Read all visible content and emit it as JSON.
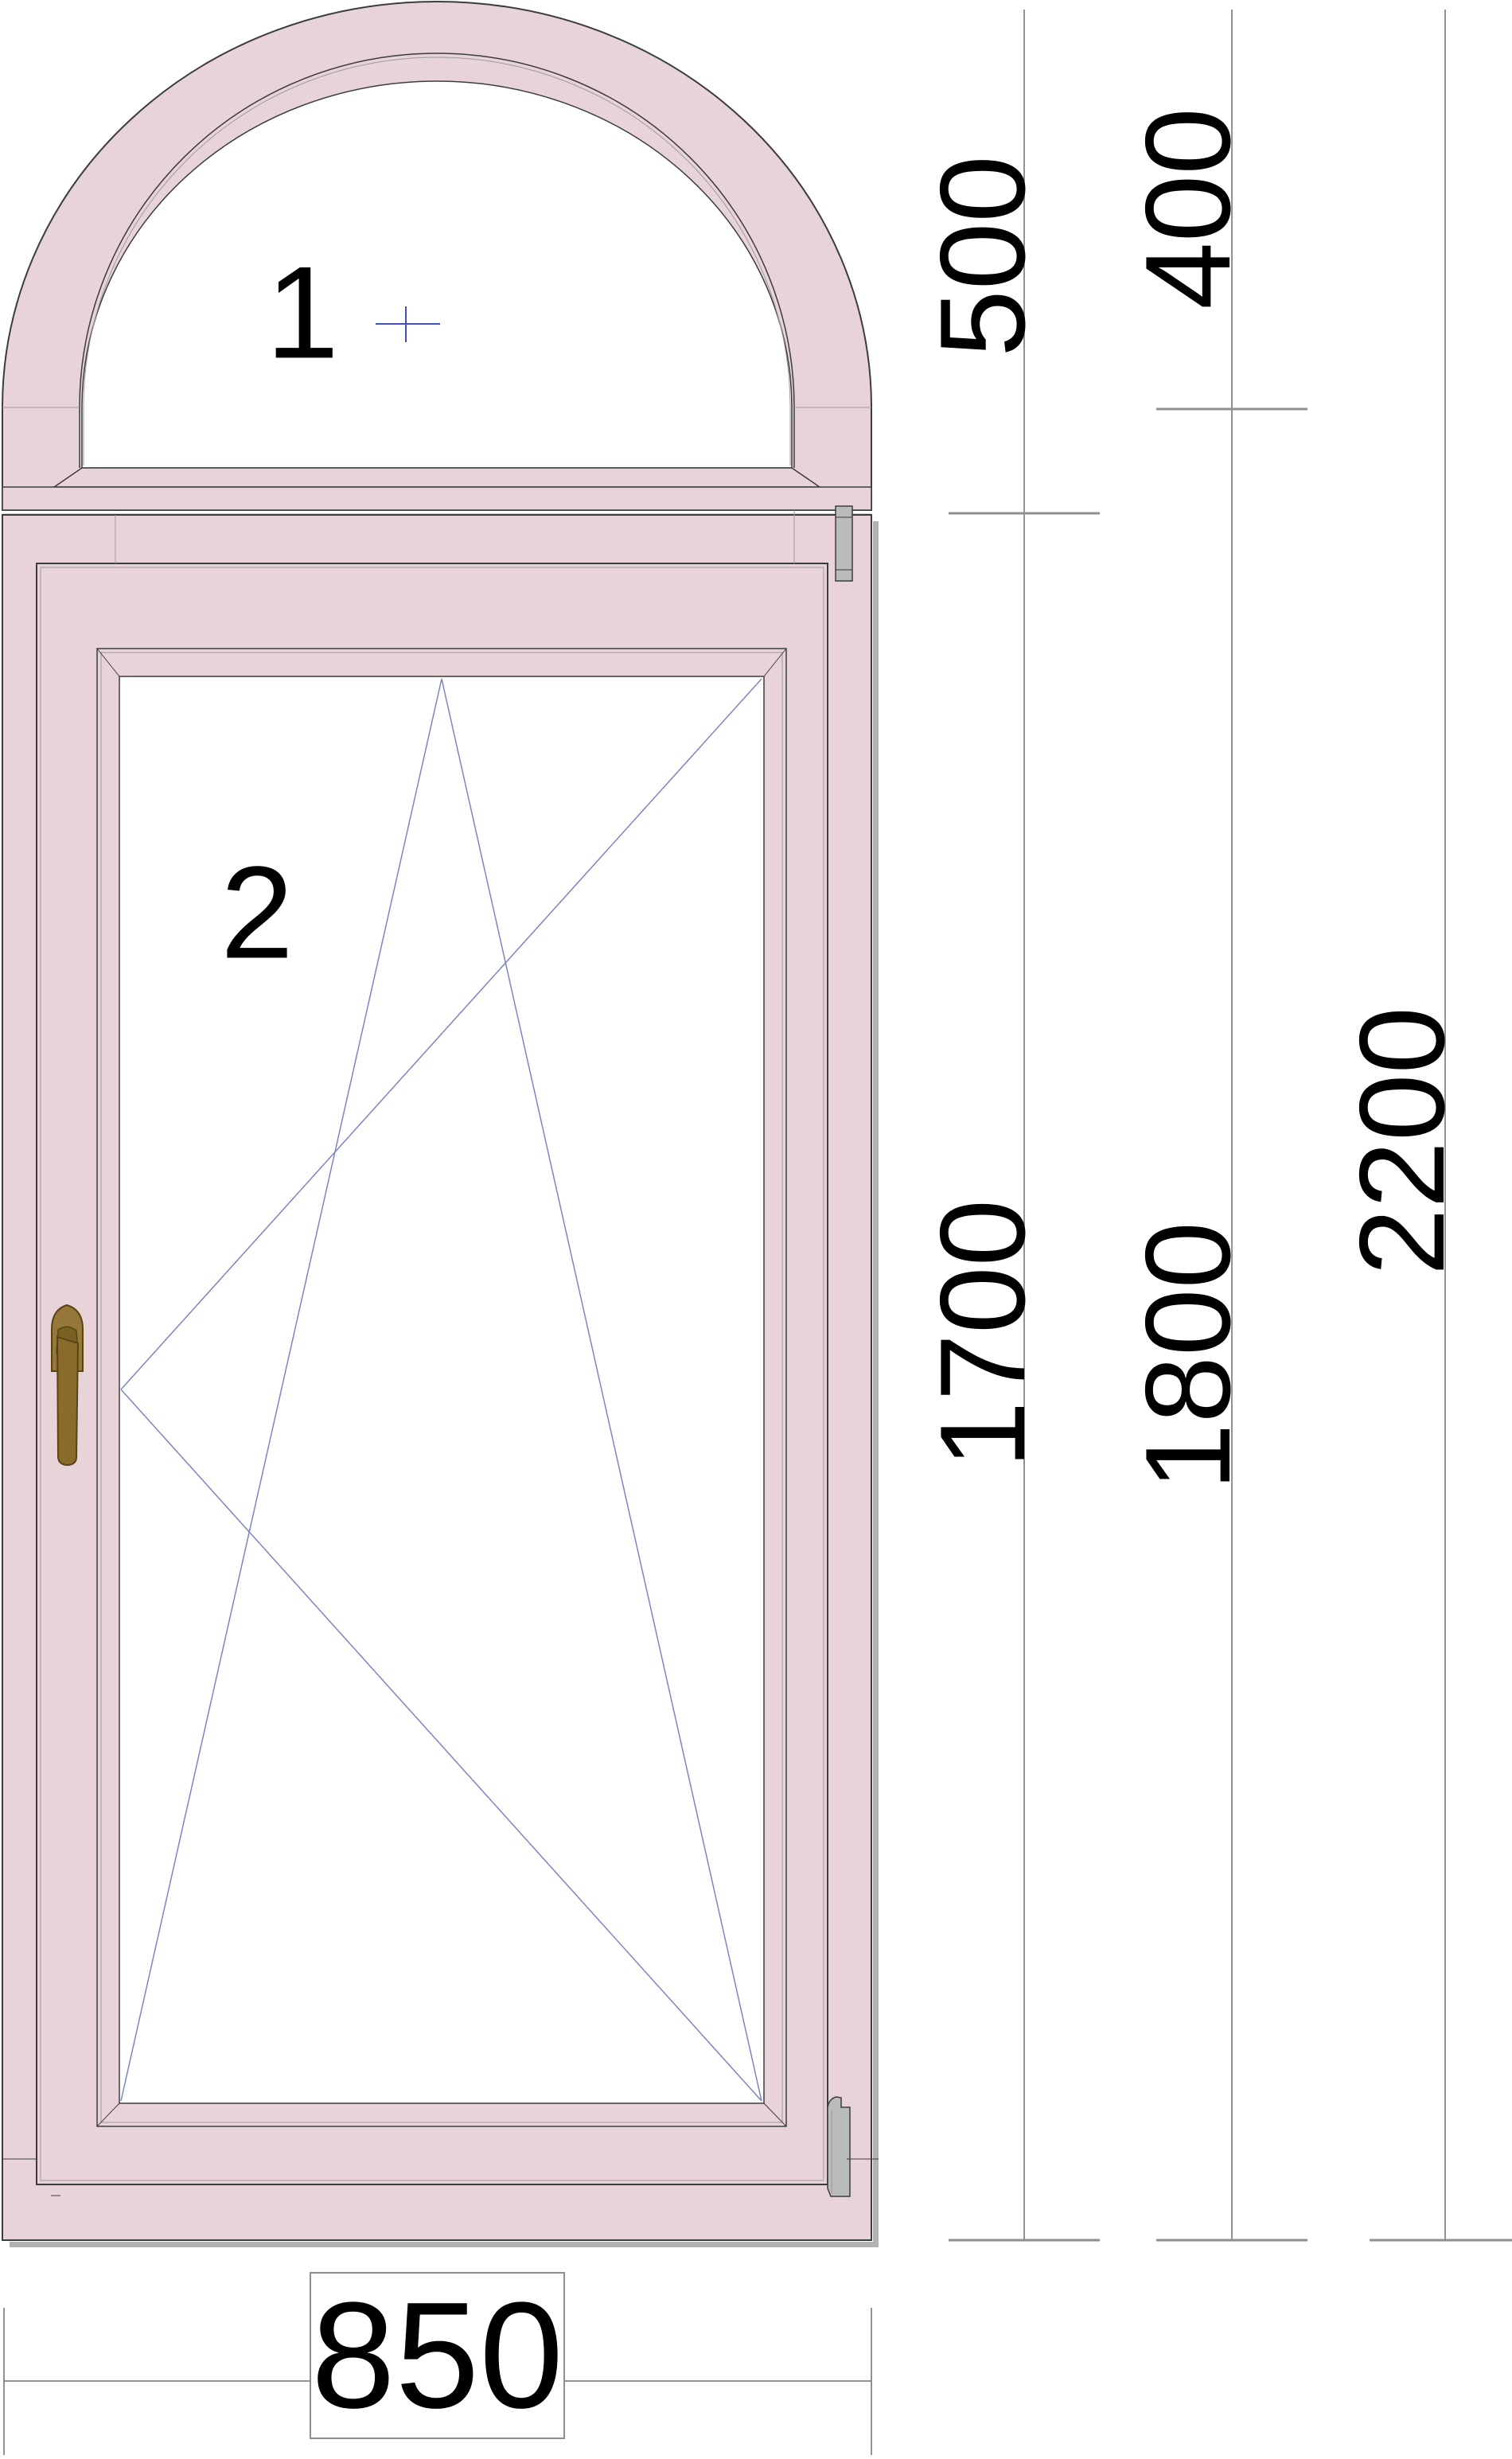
{
  "sections": [
    {
      "label": "1",
      "kind": "arched fixed light"
    },
    {
      "label": "2",
      "kind": "tilt-and-turn sash"
    }
  ],
  "dimensions": {
    "arch_height_mm": "500",
    "arch_rise_mm": "400",
    "sash_opening_height_mm": "1700",
    "lower_section_height_mm": "1800",
    "total_height_mm": "2200",
    "total_width_mm": "850"
  },
  "colors": {
    "frame": "#e8d4d8",
    "outline": "#3c3c3c",
    "glass": "#ffffff",
    "opening_symbol": "#7d84c4",
    "center_mark": "#4450b8",
    "handle": "#8a6b29",
    "handle_light": "#97783a",
    "hinge": "#b9bcba",
    "dimension_line": "#6e6e6e",
    "dimension_tick": "#8f8f8f",
    "shadow": "#b2b2b2"
  }
}
